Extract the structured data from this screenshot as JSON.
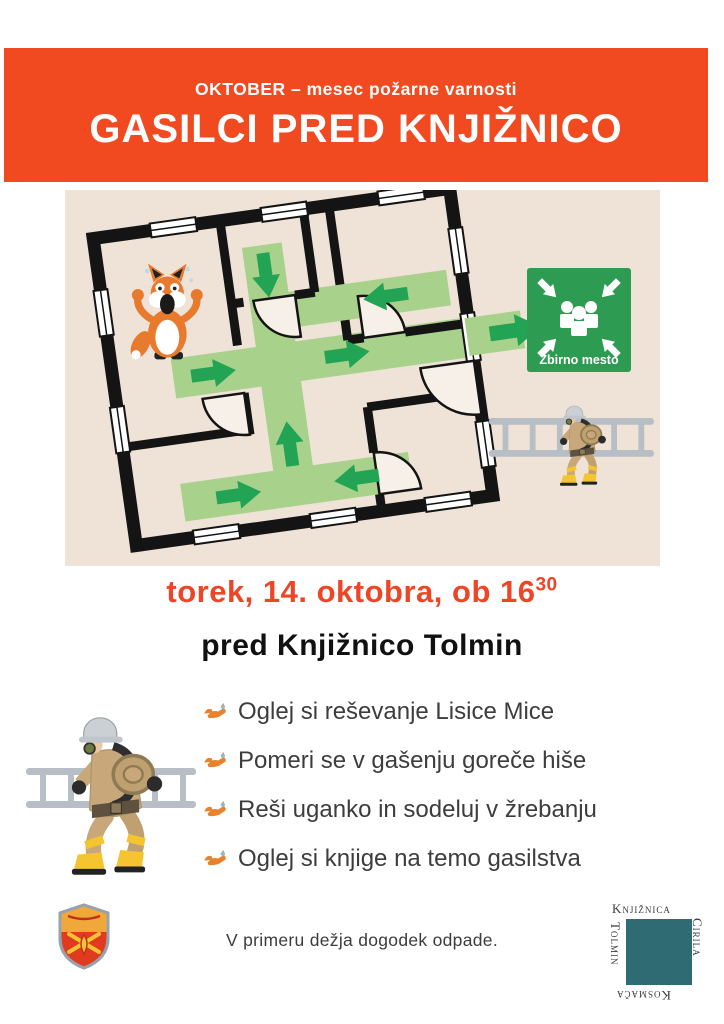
{
  "banner": {
    "bg_color": "#F14A21",
    "line1": "OKTOBER – mesec požarne varnosti",
    "line2": "GASILCI PRED KNJIŽNICO"
  },
  "event": {
    "accent_color": "#EE4527",
    "time_prefix": "torek, 14. oktobra, ob 16",
    "time_sup": "30",
    "location": "pred Knjižnico Tolmin"
  },
  "illustration": {
    "background": "#EFE3D7",
    "wall_color": "#141414",
    "path_green": "#A8D18C",
    "arrow_green": "#23A455",
    "sign": {
      "label": "Zbirno mesto",
      "green": "#2D9C52"
    },
    "fox_icon": "scared-fox-character",
    "firefighter_icon": "firefighter-carrying-ladder"
  },
  "activities": {
    "items": [
      {
        "text": "Oglej si reševanje Lisice Mice"
      },
      {
        "text": "Pomeri se v gašenju goreče hiše"
      },
      {
        "text": "Reši uganko in sodeluj v žrebanju"
      },
      {
        "text": "Oglej si knjige na temo gasilstva"
      }
    ]
  },
  "footer": {
    "disclaimer": "V primeru dežja dogodek odpade.",
    "crest_icon": "fire-brigade-crest",
    "library_logo": {
      "teal": "#2F6B72",
      "word_top": "Knjižnica",
      "word_right": "Cirila",
      "word_bottom": "Kosmača",
      "word_left": "Tolmin"
    }
  }
}
